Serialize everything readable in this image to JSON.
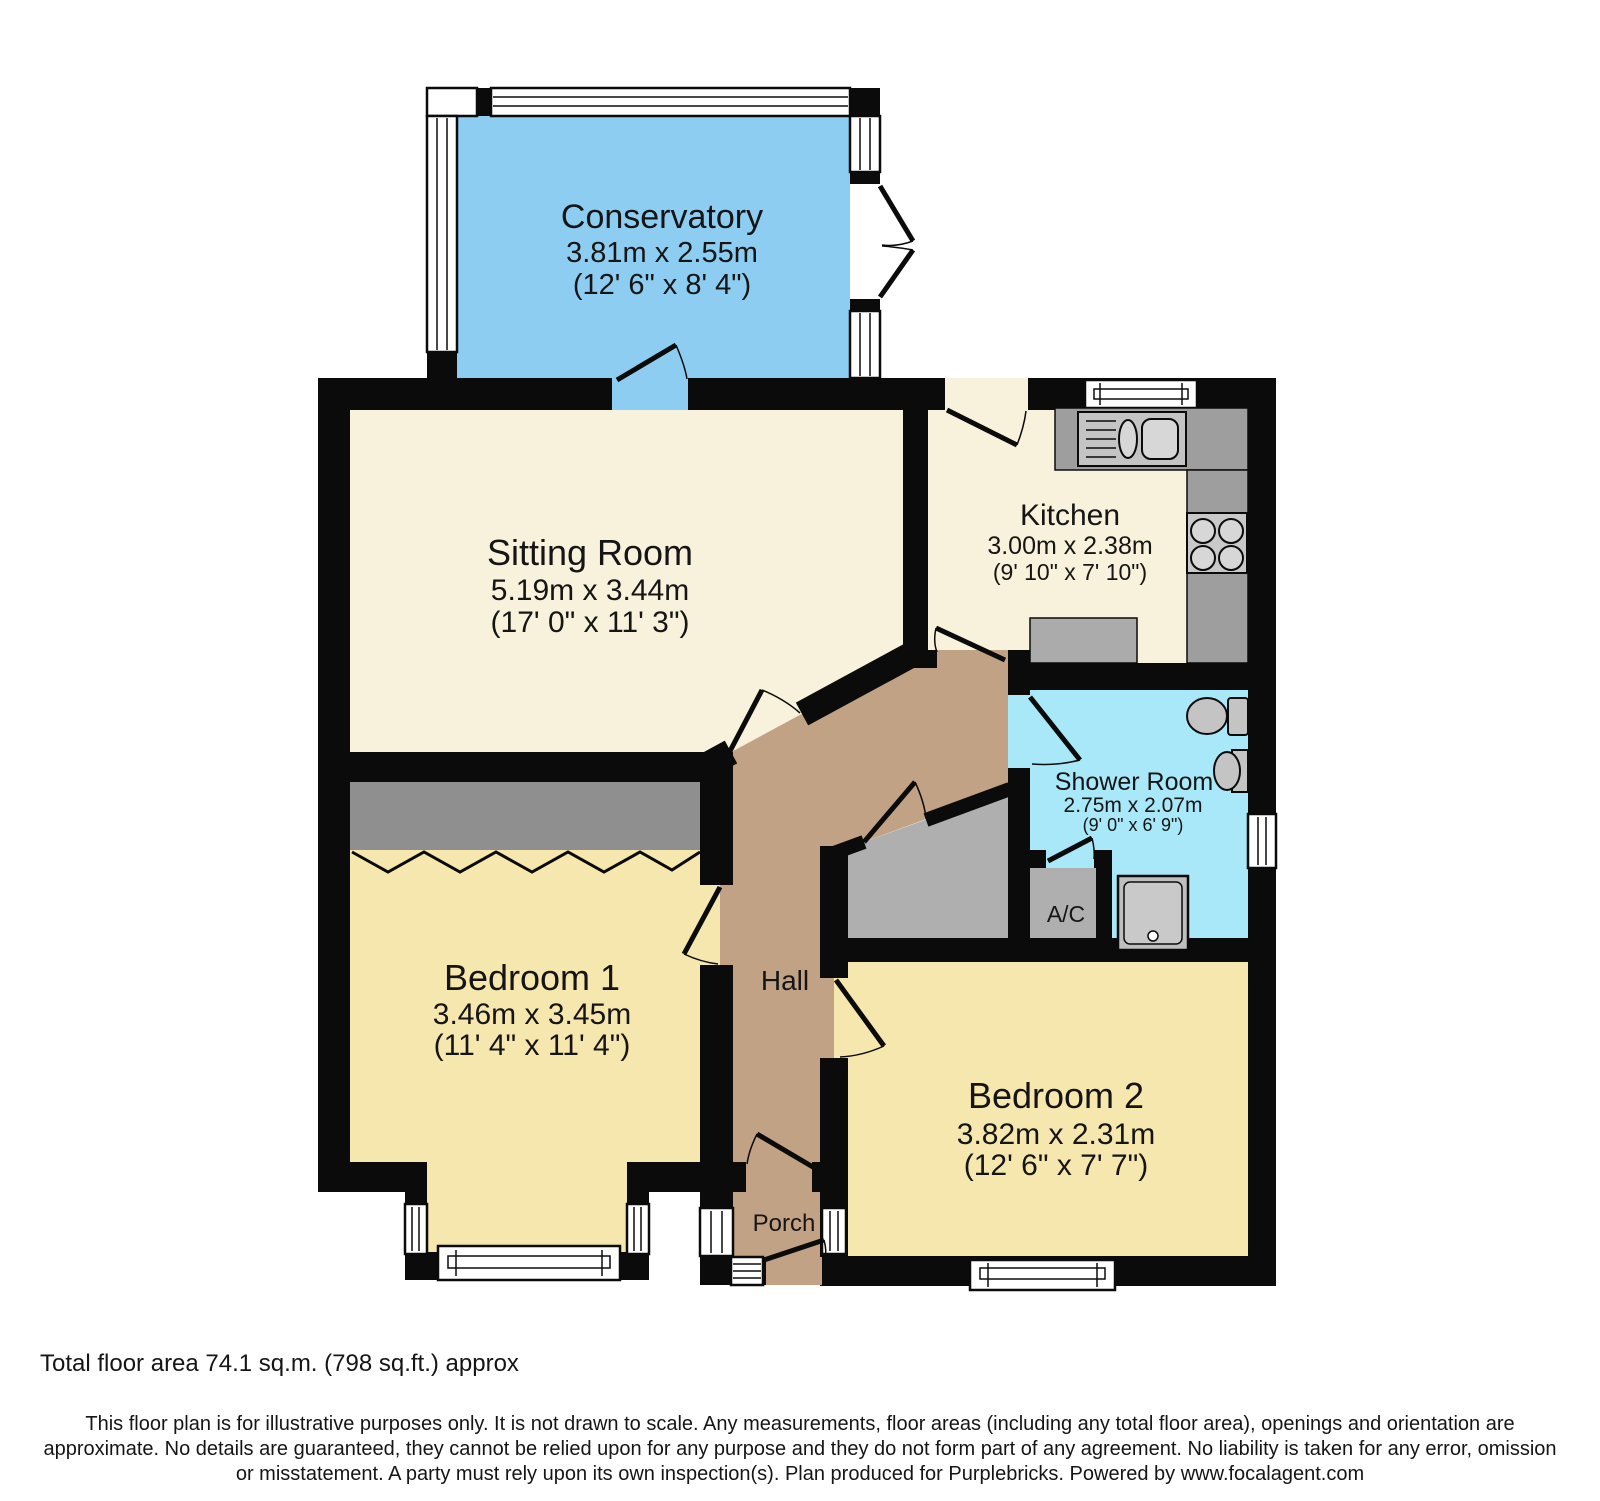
{
  "plan_title": "Bungalow floor plan",
  "rooms": {
    "conservatory": {
      "name": "Conservatory",
      "metric": "3.81m x 2.55m",
      "imperial": "(12' 6\" x 8' 4\")"
    },
    "sitting_room": {
      "name": "Sitting Room",
      "metric": "5.19m x 3.44m",
      "imperial": "(17' 0\" x 11' 3\")"
    },
    "kitchen": {
      "name": "Kitchen",
      "metric": "3.00m x 2.38m",
      "imperial": "(9' 10\" x 7' 10\")"
    },
    "shower_room": {
      "name": "Shower Room",
      "metric": "2.75m x 2.07m",
      "imperial": "(9' 0\" x 6' 9\")"
    },
    "bedroom_1": {
      "name": "Bedroom 1",
      "metric": "3.46m x 3.45m",
      "imperial": "(11' 4\" x 11' 4\")"
    },
    "bedroom_2": {
      "name": "Bedroom 2",
      "metric": "3.82m x 2.31m",
      "imperial": "(12' 6\" x 7' 7\")"
    },
    "hall": {
      "name": "Hall"
    },
    "porch": {
      "name": "Porch"
    },
    "airing_cupboard": {
      "name": "A/C"
    }
  },
  "footer": {
    "total_area": "Total floor area 74.1 sq.m. (798 sq.ft.) approx",
    "disclaimer_line1": "This floor plan is for illustrative purposes only. It is not drawn to scale. Any measurements, floor areas (including any total floor area), openings and orientation are",
    "disclaimer_line2": "approximate. No details are guaranteed, they cannot be relied upon for any purpose and they do not form part of any agreement. No liability is taken for any error, omission",
    "disclaimer_line3": "or misstatement. A party must rely upon its own inspection(s). Plan produced for Purplebricks. Powered by www.focalagent.com"
  },
  "colors": {
    "conservatory_fill": "#8DCDF2",
    "room_fill": "#F8F2DC",
    "bedroom_fill": "#F6E7AE",
    "hall_fill": "#C2A285",
    "shower_fill": "#A8E8F8",
    "store_gray": "#AFAFAF",
    "wardrobe_gray": "#8F8F8F",
    "fixture_gray": "#C4C4C4",
    "counter_gray": "#9E9E9E",
    "wall": "#0B0B0B"
  }
}
